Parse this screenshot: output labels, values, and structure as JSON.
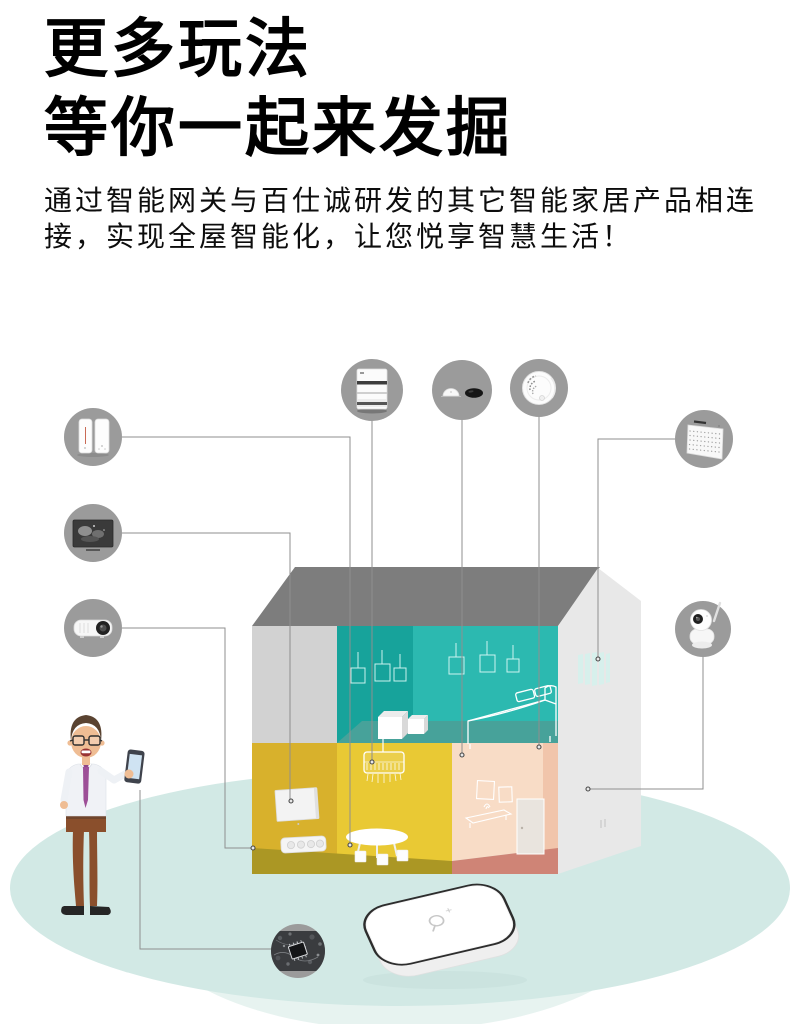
{
  "header": {
    "title_line1": "更多玩法",
    "title_line2": "等你一起来发掘",
    "description_line1": "通过智能网关与百仕诚研发的其它智能家居产品相连",
    "description_line2": "接，实现全屋智能化，让您悦享智慧生活！"
  },
  "scene": {
    "devices": [
      {
        "id": "smart-appliance-pair",
        "icon": "smart-appliance-pair-icon",
        "position": "left-top"
      },
      {
        "id": "smart-tv",
        "icon": "smart-tv-icon",
        "position": "left-middle"
      },
      {
        "id": "projector",
        "icon": "projector-icon",
        "position": "left-bottom"
      },
      {
        "id": "curtain-motor",
        "icon": "curtain-motor-icon",
        "position": "top-left"
      },
      {
        "id": "motion-sensors",
        "icon": "motion-sensor-icon",
        "position": "top-center"
      },
      {
        "id": "smoke-detector",
        "icon": "smoke-detector-icon",
        "position": "top-right"
      },
      {
        "id": "ac-grille-panel",
        "icon": "ac-grille-panel-icon",
        "position": "right-top"
      },
      {
        "id": "ip-camera",
        "icon": "ip-camera-icon",
        "position": "right-middle"
      },
      {
        "id": "chip-module",
        "icon": "chip-module-icon",
        "position": "bottom-left"
      },
      {
        "id": "gateway",
        "icon": "gateway-device-icon",
        "position": "bottom-center"
      },
      {
        "id": "user-with-smartphone",
        "icon": "person-smartphone-icon",
        "position": "left-corner"
      }
    ]
  },
  "colors": {
    "ellipse": "#d2e9e5",
    "ellipse_under": "#e7f3f0",
    "roof": "#7d7d7d",
    "wall_gray": "#d2d2d2",
    "gable": "#e8e8e8",
    "teal_dark": "#17a39b",
    "teal_light": "#2cb9b0",
    "teal_floor": "#47a29a",
    "yellow_dark": "#d8b12c",
    "yellow": "#e9c934",
    "floor_olive": "#ab9724",
    "pink": "#f8dcc6",
    "pink_side": "#f1c5ab",
    "floor_salmon": "#cf8476",
    "circle_gray": "#9b9b9b",
    "line_gray": "#8f8f8f",
    "vent": "#d7f0ec",
    "tie_purple": "#9d4f97",
    "pants_brown": "#8a4f2c",
    "hair_brown": "#5a4331",
    "skin": "#efbd94",
    "phone_screen": "#cfe3f2"
  }
}
